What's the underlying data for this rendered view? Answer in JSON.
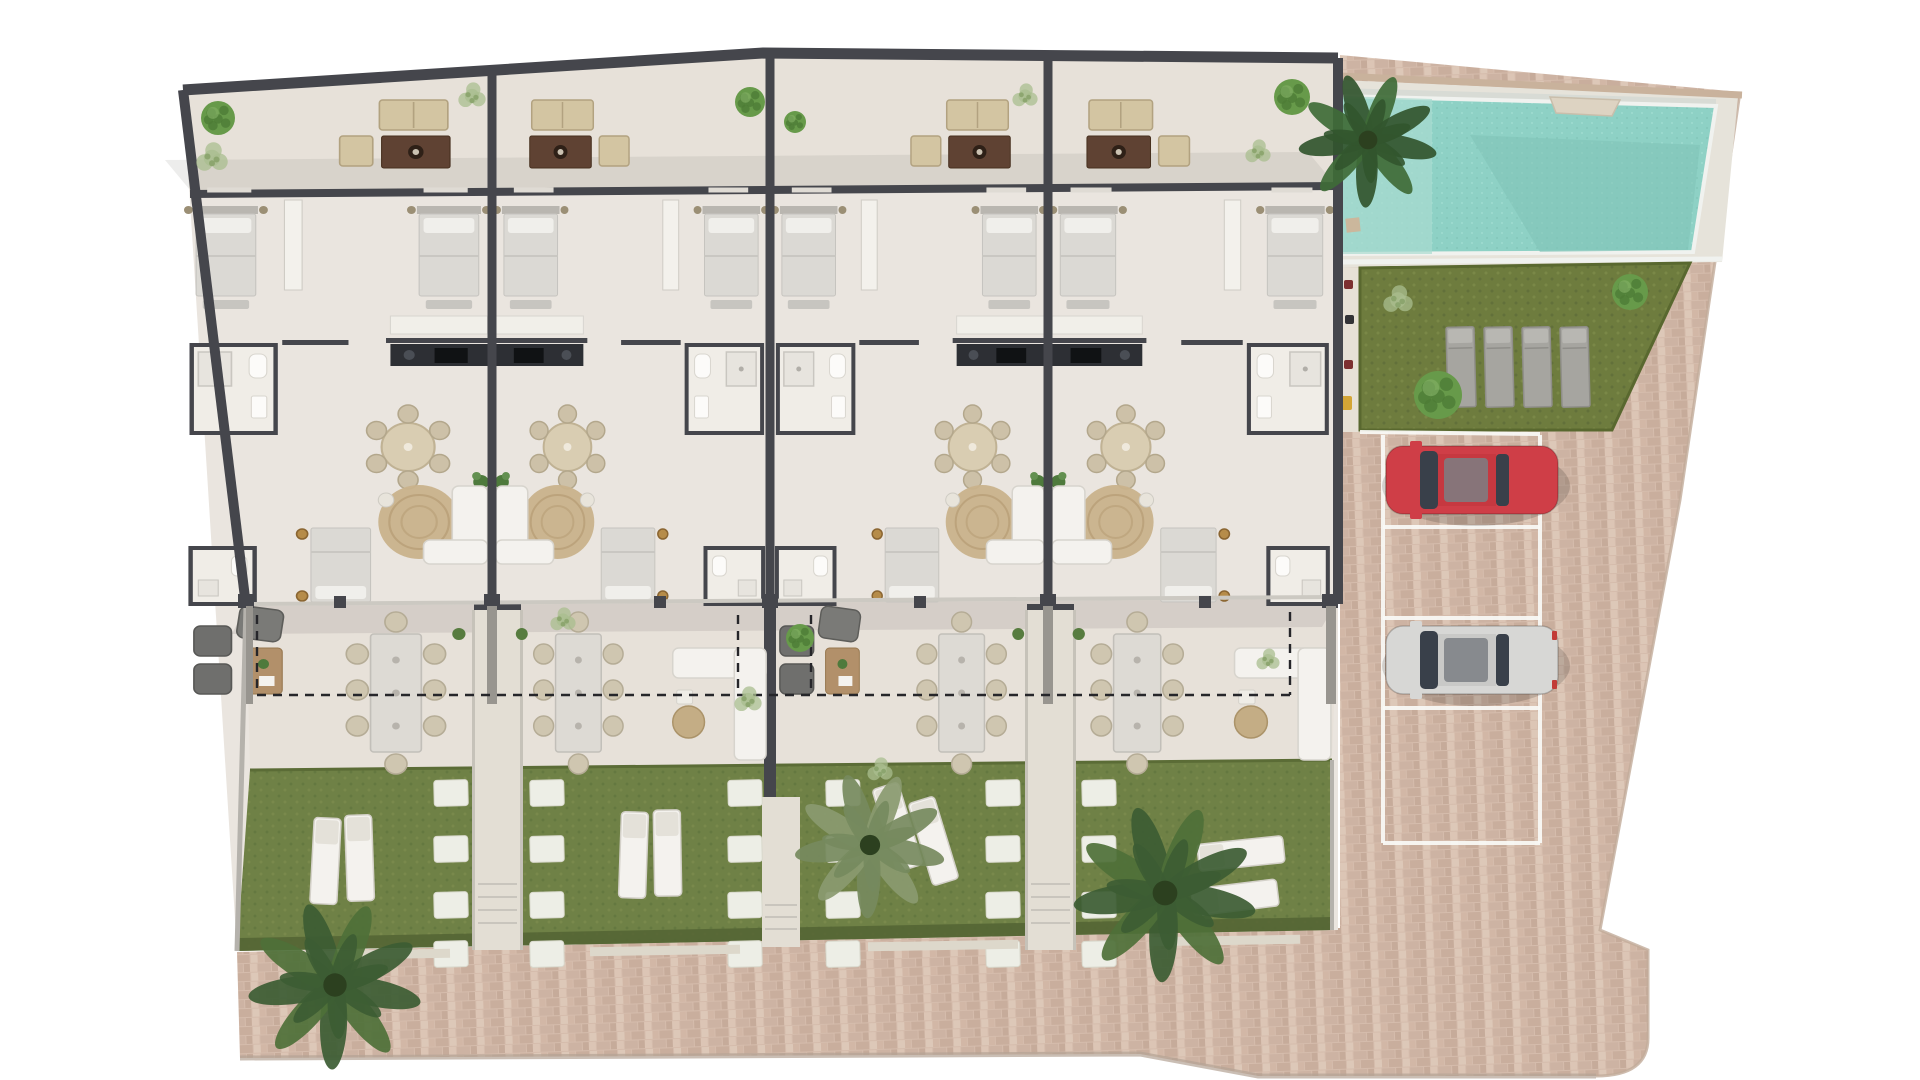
{
  "meta": {
    "description": "Aerial 2D rendered site plan: four terraced holiday homes with roof-street terraces, interior furniture, private rear gardens with sun loungers and palm trees, a communal swimming pool, a lawn with four sunbeds, and a cobbled driveway with four parking bays, one red car and one silver car"
  },
  "palette": {
    "background": "#ffffff",
    "wall": "#45464c",
    "floor": "#eae5df",
    "terrace_floor": "#e7e1d9",
    "glass": "#ccc9c2",
    "fence": "#b5b2ac",
    "paving_base": "#d5bcac",
    "paving_edge": "#b3a294",
    "pool_water": "#8ed1c5",
    "pool_shallow": "#aadbd0",
    "pool_deep": "#7fc3b6",
    "pool_deck": "#e6e3da",
    "pool_rim": "#f0f2ef",
    "pool_topwall": "#c9b29c",
    "lawn": "#6e7c3e",
    "garden_grass": "#6f8146",
    "grass_dark": "#546434",
    "corridor": "#e3ded4",
    "stone": "#edeee6",
    "sill": "#ddd8cb",
    "sofa_beige": "#d3c5a2",
    "table_brown": "#5f4233",
    "wood": "#b2906a",
    "bed": "#dbd9d4",
    "pillow": "#f0efeb",
    "white_furniture": "#f4f2ee",
    "gray_furniture": "#6f6f6d",
    "sunbed_gray": "#a6a5a0",
    "kitchen_counter": "#2d2f34",
    "stove": "#101214",
    "rug": "#c9b28b",
    "brass": "#b68c49",
    "car_red": "#cf3e47",
    "car_silver": "#d7d7d5",
    "car_glass": "#39404a",
    "marking_white": "#fafaf7",
    "dashed_line": "#26262a",
    "palm_dark": "#3c5c33",
    "palm_mid": "#4e7038",
    "palm_light": "#8a9a70",
    "tree_green": "#679a4a",
    "bush_light": "#a9bd8f"
  },
  "site": {
    "units": {
      "count": 4,
      "list": [
        {
          "id": "unit-1",
          "ground_terrace_style": "armchairs"
        },
        {
          "id": "unit-2",
          "ground_terrace_style": "corner-sofa"
        },
        {
          "id": "unit-3",
          "ground_terrace_style": "armchairs"
        },
        {
          "id": "unit-4",
          "ground_terrace_style": "corner-sofa"
        }
      ],
      "per_unit_features": {
        "roof_terrace": [
          "2-seat sofa",
          "armchair",
          "coffee table"
        ],
        "upper_bedrooms": 2,
        "bathrooms": 2,
        "kitchen": "rear counter with hob",
        "dining": "round table with 6 chairs",
        "living": "corner sofa on round rug",
        "lower_bedroom": 1,
        "ground_terrace_dining": "table with 8 chairs",
        "garden_loungers": 2
      }
    },
    "pool": {
      "shape": "trapezoid",
      "steps": true
    },
    "lawn": {
      "sunbeds": 4
    },
    "parking": {
      "spaces": 4,
      "occupied": 2,
      "cars": [
        {
          "color_name": "red"
        },
        {
          "color_name": "silver"
        }
      ]
    },
    "gardens": {
      "count": 4,
      "stepping_stone_columns": 6,
      "stones_per_column": 4
    },
    "vegetation": {
      "palm_trees": 4,
      "round_trees": 5,
      "light_bushes": 7
    },
    "boundary": {
      "dashed_property_line": true
    }
  }
}
